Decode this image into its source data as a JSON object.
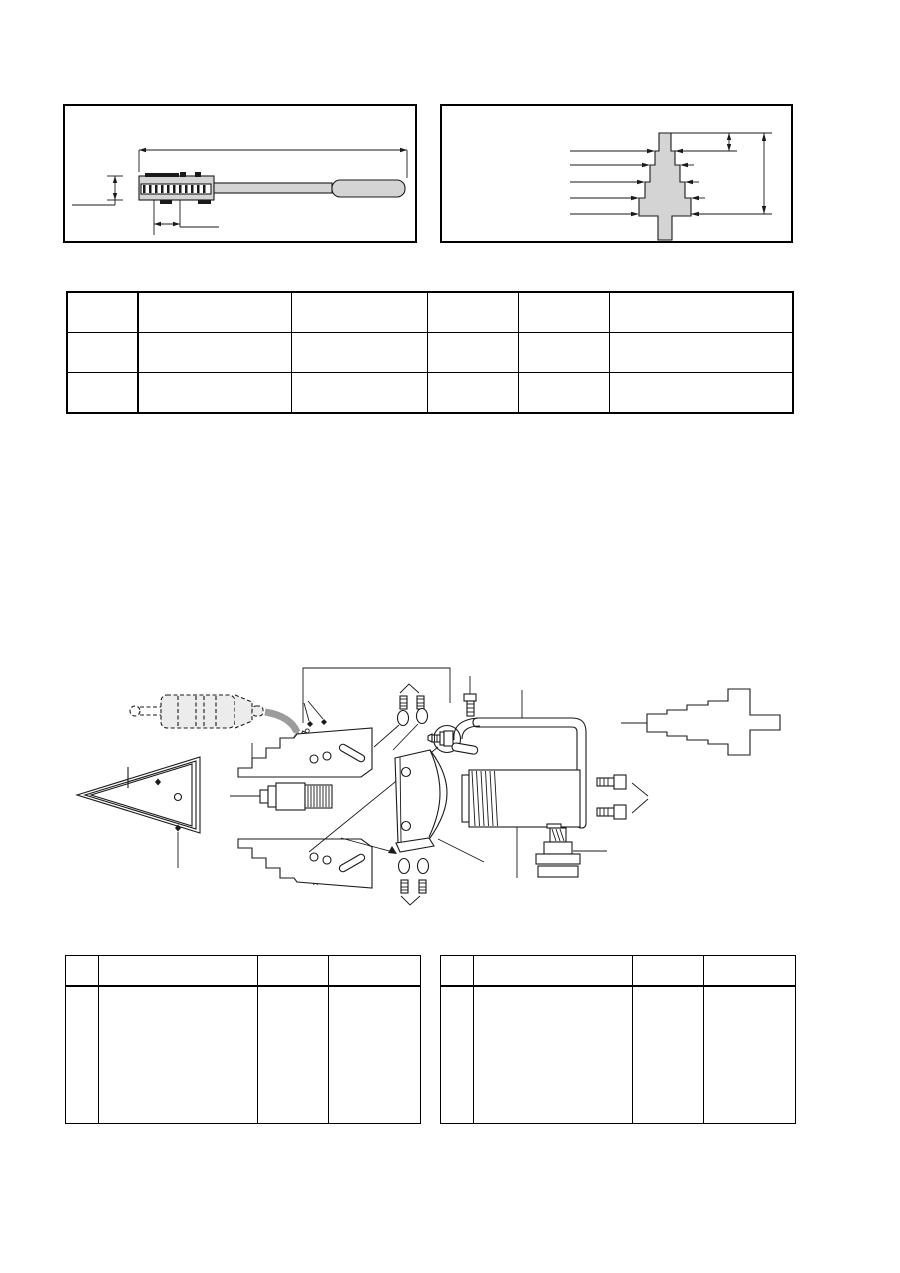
{
  "page": {
    "width": 900,
    "height": 1273,
    "background": "#ffffff"
  },
  "colors": {
    "page_bg": "#ffffff",
    "line": "#1a1a1a",
    "fill_light": "#d4d4d4",
    "fill_soft": "#ececec",
    "fill_arrow": "#9c9c9c",
    "table_border": "#000000"
  },
  "figures": {
    "tool_gauge": {
      "caption": "",
      "parts": [
        "overall-length-dimension",
        "gauge-head",
        "comb-teeth",
        "tool-shaft",
        "grip-handle",
        "height-dimension",
        "tooth-pitch-dimension"
      ]
    },
    "step_gauge": {
      "caption": "",
      "parts": [
        "stepped-gauge-body",
        "step-leader-lines",
        "step-height-dimension",
        "overall-height-dimension"
      ]
    },
    "exploded_view": {
      "caption": "",
      "parts": [
        "label-bracket-leader",
        "dashed-driver-tool",
        "rotate-arrow",
        "adjust-screw-top",
        "adjust-screw-bottom",
        "alignment-marks-top",
        "alignment-marks-bottom",
        "upper-stepped-bracket",
        "lower-stepped-bracket",
        "threaded-adapter",
        "triangular-wedge",
        "clamp-and-bolt",
        "handle-tube",
        "screw-near-clamp",
        "washer-screw-set-top",
        "washer-screw-set-bottom",
        "curved-mounting-plate",
        "motor",
        "socket-screws",
        "shaft-adapter-stack",
        "stepped-shaft",
        "diagonal-reference-line"
      ]
    }
  },
  "spec_table": {
    "rows": [
      [
        "",
        "",
        "",
        "",
        "",
        ""
      ],
      [
        "",
        "",
        "",
        "",
        "",
        ""
      ],
      [
        "",
        "",
        "",
        "",
        "",
        ""
      ]
    ]
  },
  "parts_table_left": {
    "header": [
      "",
      "",
      "",
      ""
    ],
    "rows": [
      [
        "",
        "",
        "",
        ""
      ]
    ]
  },
  "parts_table_right": {
    "header": [
      "",
      "",
      "",
      ""
    ],
    "rows": [
      [
        "",
        "",
        "",
        ""
      ]
    ]
  }
}
